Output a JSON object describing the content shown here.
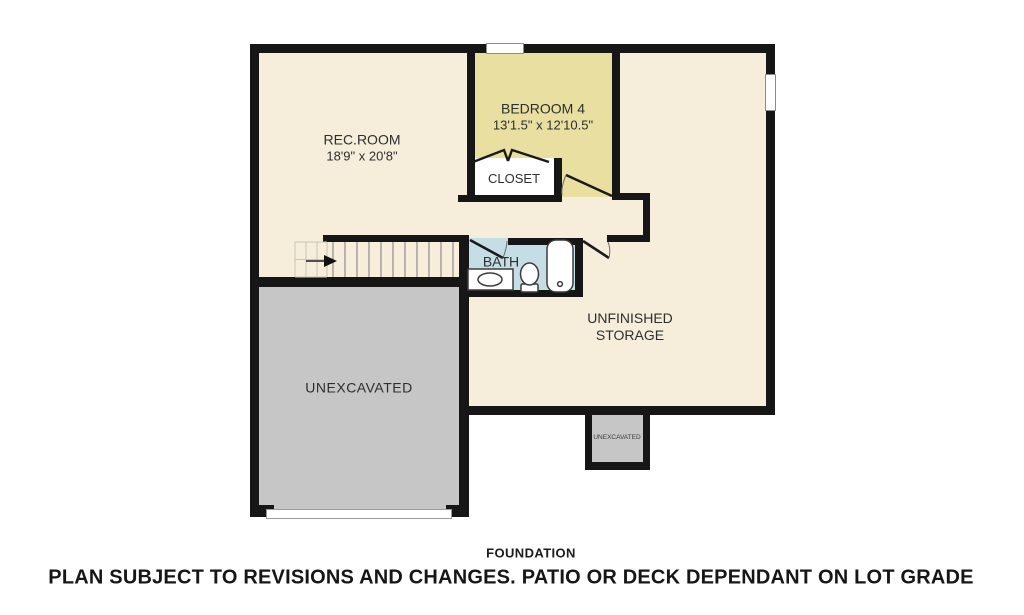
{
  "plan": {
    "colors": {
      "wall": "#161616",
      "floor": "#f6eddb",
      "bedroom_floor": "#e8dfa1",
      "bath_floor": "#c5dee5",
      "closet_floor": "#ffffff",
      "unexcavated": "#c6c6c6",
      "text": "#2e2e2e"
    },
    "rooms": {
      "rec_room": {
        "label": "REC.ROOM",
        "dimensions": "18'9\" x 20'8\""
      },
      "bedroom_4": {
        "label": "BEDROOM 4",
        "dimensions": "13'1.5\" x 12'10.5\""
      },
      "closet": {
        "label": "CLOSET"
      },
      "bath": {
        "label": "BATH"
      },
      "unfinished_storage": {
        "label_line_1": "UNFINISHED",
        "label_line_2": "STORAGE"
      },
      "unexcavated": {
        "label": "UNEXCAVATED"
      },
      "unexcavated_small": {
        "label": "UNEXCAVATED"
      }
    },
    "footer": {
      "plan_title": "FOUNDATION",
      "disclaimer": "PLAN SUBJECT TO REVISIONS AND CHANGES. PATIO OR DECK DEPENDANT ON LOT GRADE"
    }
  }
}
